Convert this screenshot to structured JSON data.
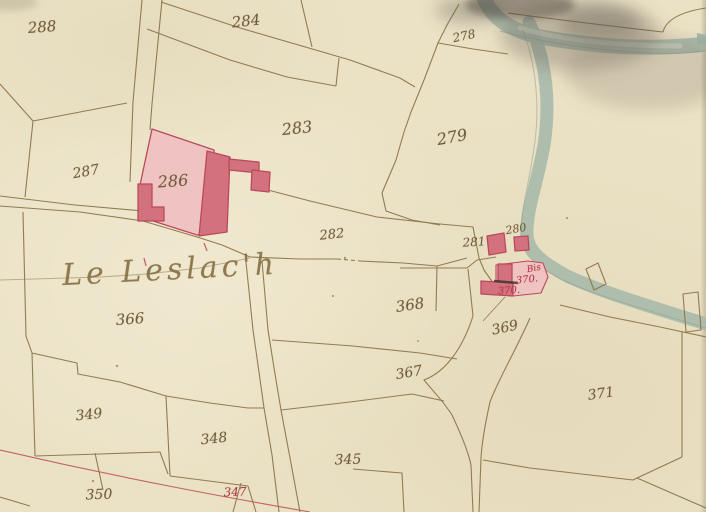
{
  "map": {
    "kind": "hand-drawn cadastral map sheet",
    "place_name": "Le Leslac'h",
    "labels": [
      {
        "id": "288",
        "text": "288",
        "x": 42,
        "y": 27,
        "size": 15,
        "rot": -4,
        "ink": "sepia"
      },
      {
        "id": "284",
        "text": "284",
        "x": 246,
        "y": 21,
        "size": 15,
        "rot": -6,
        "ink": "sepia"
      },
      {
        "id": "278",
        "text": "278",
        "x": 464,
        "y": 36,
        "size": 12,
        "rot": -12,
        "ink": "sepia"
      },
      {
        "id": "283",
        "text": "283",
        "x": 297,
        "y": 128,
        "size": 16,
        "rot": -6,
        "ink": "sepia"
      },
      {
        "id": "279",
        "text": "279",
        "x": 452,
        "y": 137,
        "size": 16,
        "rot": -10,
        "ink": "sepia"
      },
      {
        "id": "287",
        "text": "287",
        "x": 86,
        "y": 172,
        "size": 14,
        "rot": -10,
        "ink": "sepia"
      },
      {
        "id": "286",
        "text": "286",
        "x": 173,
        "y": 181,
        "size": 16,
        "rot": -4,
        "ink": "sepia"
      },
      {
        "id": "282",
        "text": "282",
        "x": 332,
        "y": 235,
        "size": 13,
        "rot": -6,
        "ink": "sepia"
      },
      {
        "id": "281",
        "text": "281",
        "x": 474,
        "y": 242,
        "size": 12,
        "rot": -4,
        "ink": "sepia"
      },
      {
        "id": "280",
        "text": "280",
        "x": 516,
        "y": 229,
        "size": 11,
        "rot": -10,
        "ink": "sepia"
      },
      {
        "id": "370bis",
        "text": "Bis",
        "x": 534,
        "y": 269,
        "size": 9,
        "rot": -10,
        "ink": "red"
      },
      {
        "id": "370a",
        "text": "370.",
        "x": 527,
        "y": 280,
        "size": 10,
        "rot": -6,
        "ink": "red"
      },
      {
        "id": "370b",
        "text": "370.",
        "x": 509,
        "y": 291,
        "size": 10,
        "rot": -4,
        "ink": "red"
      },
      {
        "id": "366",
        "text": "366",
        "x": 130,
        "y": 319,
        "size": 15,
        "rot": -4,
        "ink": "sepia"
      },
      {
        "id": "368",
        "text": "368",
        "x": 410,
        "y": 305,
        "size": 15,
        "rot": -8,
        "ink": "sepia"
      },
      {
        "id": "369",
        "text": "369",
        "x": 505,
        "y": 328,
        "size": 14,
        "rot": -12,
        "ink": "sepia"
      },
      {
        "id": "367",
        "text": "367",
        "x": 409,
        "y": 373,
        "size": 14,
        "rot": -10,
        "ink": "sepia"
      },
      {
        "id": "371",
        "text": "371",
        "x": 601,
        "y": 394,
        "size": 14,
        "rot": -8,
        "ink": "sepia"
      },
      {
        "id": "349",
        "text": "349",
        "x": 89,
        "y": 415,
        "size": 14,
        "rot": -6,
        "ink": "sepia"
      },
      {
        "id": "348",
        "text": "348",
        "x": 214,
        "y": 439,
        "size": 14,
        "rot": -6,
        "ink": "sepia"
      },
      {
        "id": "345",
        "text": "345",
        "x": 348,
        "y": 460,
        "size": 14,
        "rot": -2,
        "ink": "sepia"
      },
      {
        "id": "350",
        "text": "350",
        "x": 99,
        "y": 495,
        "size": 14,
        "rot": -2,
        "ink": "sepia"
      },
      {
        "id": "347",
        "text": "347",
        "x": 235,
        "y": 492,
        "size": 12,
        "rot": -2,
        "ink": "red"
      },
      {
        "id": "place-name",
        "text": "Le Leslac'h",
        "x": 170,
        "y": 270,
        "size": 30,
        "rot": -3,
        "ink": "title"
      }
    ],
    "features": [
      "stream-with-two-branches",
      "footbridge-upper",
      "footbridge-lower",
      "weir-mark",
      "highlighted-building-286",
      "building-281",
      "building-280",
      "building-370bis",
      "road-east-west",
      "lane-north",
      "road-to-south",
      "lane-to-southeast",
      "red-section-line",
      "ink-stain"
    ],
    "ink_colors": {
      "paper": "#ebe2c6",
      "sepia_line": "#8b7348",
      "river_fill": "#a7b9aa",
      "building_light": "#f0c3c3",
      "building_dark": "#d4717f",
      "building_stroke": "#b94a5c",
      "red_ink": "#b23a48",
      "red_line": "#c2606a"
    }
  }
}
